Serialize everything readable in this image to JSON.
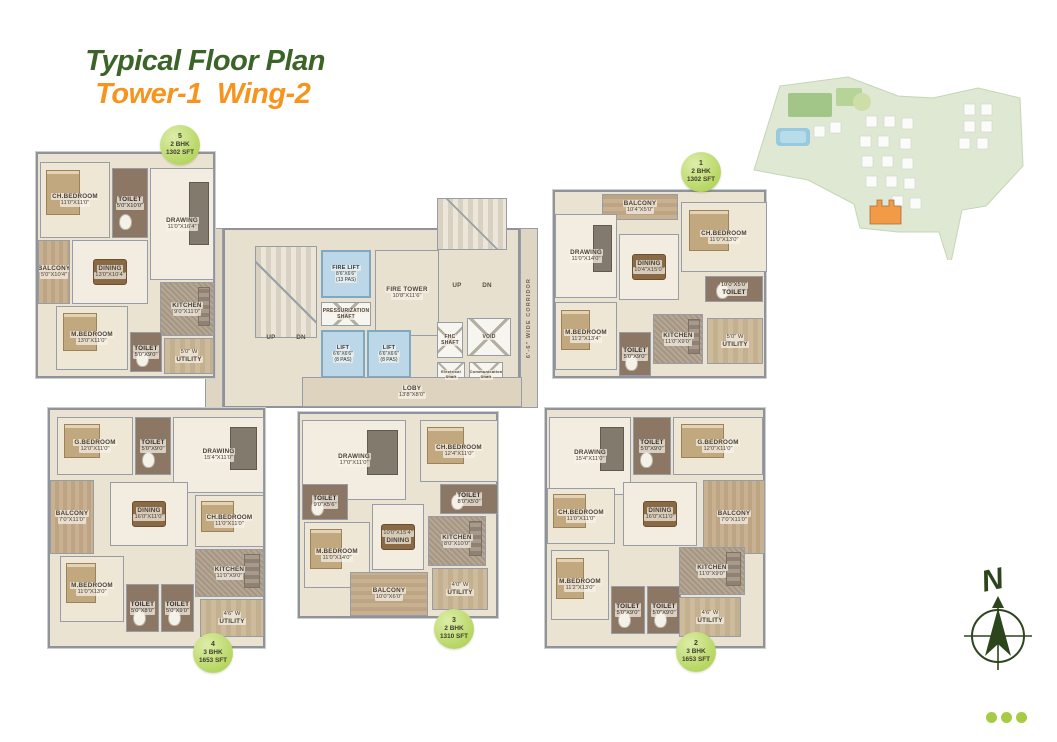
{
  "title": {
    "main": "Typical Floor Plan",
    "accent": "Tower-1  Wing-2"
  },
  "colors": {
    "title_green": "#3c6428",
    "title_orange": "#f7941e",
    "badge_green": "#b4d55e",
    "highlight_orange": "#f08119",
    "compass_green": "#2c451c"
  },
  "core": {
    "corridor_label": "6'-6\" WIDE CORRIDOR",
    "rooms": [
      {
        "label": "",
        "x": 212,
        "y": -32,
        "w": 70,
        "h": 52,
        "type": "stairs"
      },
      {
        "label": "",
        "x": 30,
        "y": 16,
        "w": 62,
        "h": 92,
        "type": "stairs"
      },
      {
        "label": "FIRE TOWER",
        "dims": "10'8\"X11'6\"",
        "x": 150,
        "y": 20,
        "w": 64,
        "h": 86,
        "type": "open"
      },
      {
        "label": "FIRE LIFT",
        "dims": "8'6\"X6'6\"",
        "extra": "(13 PAS)",
        "x": 96,
        "y": 20,
        "w": 50,
        "h": 48,
        "type": "lift"
      },
      {
        "label": "PRESSURIZATION",
        "label2": "SHAFT",
        "x": 96,
        "y": 72,
        "w": 50,
        "h": 24,
        "type": "xshaft"
      },
      {
        "label": "LIFT",
        "dims": "6'6\"X6'6\"",
        "extra": "(8 PAS)",
        "x": 96,
        "y": 100,
        "w": 44,
        "h": 48,
        "type": "lift"
      },
      {
        "label": "LIFT",
        "dims": "6'6\"X6'6\"",
        "extra": "(8 PAS)",
        "x": 142,
        "y": 100,
        "w": 44,
        "h": 48,
        "type": "lift"
      },
      {
        "label": "FHC",
        "label2": "SHAFT",
        "x": 212,
        "y": 92,
        "w": 26,
        "h": 36,
        "type": "xshaft"
      },
      {
        "label": "VOID",
        "x": 242,
        "y": 88,
        "w": 44,
        "h": 38,
        "type": "xshaft"
      },
      {
        "label": "Electrical",
        "label2": "Shaft",
        "x": 212,
        "y": 132,
        "w": 28,
        "h": 26,
        "type": "xshaft",
        "small": true
      },
      {
        "label": "Communication",
        "label2": "Shaft",
        "x": 244,
        "y": 132,
        "w": 34,
        "h": 26,
        "type": "xshaft",
        "small": true
      },
      {
        "label": "UP",
        "x": 36,
        "y": 102,
        "w": 20,
        "h": 12,
        "type": "plain"
      },
      {
        "label": "DN",
        "x": 66,
        "y": 102,
        "w": 20,
        "h": 12,
        "type": "plain"
      },
      {
        "label": "UP",
        "x": 222,
        "y": 50,
        "w": 20,
        "h": 12,
        "type": "plain"
      },
      {
        "label": "DN",
        "x": 252,
        "y": 50,
        "w": 20,
        "h": 12,
        "type": "plain"
      },
      {
        "label": "LOBY",
        "dims": "13'8\"X8'0\"",
        "x": 77,
        "y": 147,
        "w": 220,
        "h": 30,
        "type": "lobby"
      }
    ]
  },
  "units": {
    "unit5": {
      "badge": {
        "number": "5",
        "type": "2 BHK",
        "area": "1302 SFT"
      },
      "rooms": [
        {
          "label": "CH.BEDROOM",
          "dims": "11'0\"X11'0\"",
          "x": 2,
          "y": 8,
          "w": 70,
          "h": 76,
          "type": "bedroom"
        },
        {
          "label": "TOILET",
          "dims": "5'0\"X10'0\"",
          "x": 74,
          "y": 14,
          "w": 36,
          "h": 70,
          "type": "toilet"
        },
        {
          "label": "DRAWING",
          "dims": "11'0\"X16'4\"",
          "x": 112,
          "y": 14,
          "w": 64,
          "h": 112,
          "type": "drawing"
        },
        {
          "label": "BALCONY",
          "dims": "5'0\"X10'4\"",
          "x": 0,
          "y": 86,
          "w": 32,
          "h": 64,
          "type": "balcony"
        },
        {
          "label": "DINING",
          "dims": "13'0\"X10'4\"",
          "x": 34,
          "y": 86,
          "w": 76,
          "h": 64,
          "type": "dining"
        },
        {
          "label": "KITCHEN",
          "dims": "9'0\"X11'0\"",
          "x": 122,
          "y": 128,
          "w": 54,
          "h": 54,
          "type": "kitchen"
        },
        {
          "label": "M.BEDROOM",
          "dims": "13'0\"X11'0\"",
          "x": 18,
          "y": 152,
          "w": 72,
          "h": 64,
          "type": "bedroom"
        },
        {
          "label": "TOILET",
          "dims": "5'0\"X9'0\"",
          "x": 92,
          "y": 178,
          "w": 32,
          "h": 40,
          "type": "toilet"
        },
        {
          "label": "UTILITY",
          "dims": "5'0\" W",
          "dims_first": true,
          "x": 126,
          "y": 184,
          "w": 50,
          "h": 36,
          "type": "utility"
        }
      ]
    },
    "unit1": {
      "badge": {
        "number": "1",
        "type": "2 BHK",
        "area": "1302 SFT"
      },
      "rooms": [
        {
          "label": "BALCONY",
          "dims": "10'4\"X5'0\"",
          "x": 47,
          "y": 2,
          "w": 76,
          "h": 26,
          "type": "balcony",
          "hstripe": true
        },
        {
          "label": "CH.BEDROOM",
          "dims": "11'0\"X13'0\"",
          "x": 126,
          "y": 10,
          "w": 86,
          "h": 70,
          "type": "bedroom"
        },
        {
          "label": "DRAWING",
          "dims": "11'0\"X14'0\"",
          "x": 0,
          "y": 22,
          "w": 62,
          "h": 84,
          "type": "drawing"
        },
        {
          "label": "DINING",
          "dims": "10'4\"X15'0\"",
          "x": 64,
          "y": 42,
          "w": 60,
          "h": 66,
          "type": "dining"
        },
        {
          "label": "TOILET",
          "dims": "10'0\"X5'0\"",
          "dims_first": true,
          "x": 150,
          "y": 84,
          "w": 58,
          "h": 26,
          "type": "toilet"
        },
        {
          "label": "M.BEDROOM",
          "dims": "11'2\"X13'4\"",
          "x": 0,
          "y": 110,
          "w": 62,
          "h": 68,
          "type": "bedroom"
        },
        {
          "label": "TOILET",
          "dims": "5'0\"X9'0\"",
          "x": 64,
          "y": 140,
          "w": 32,
          "h": 44,
          "type": "toilet"
        },
        {
          "label": "KITCHEN",
          "dims": "11'0\"X9'0\"",
          "x": 98,
          "y": 122,
          "w": 50,
          "h": 50,
          "type": "kitchen"
        },
        {
          "label": "UTILITY",
          "dims": "5'0\" W",
          "dims_first": true,
          "x": 152,
          "y": 126,
          "w": 56,
          "h": 46,
          "type": "utility"
        }
      ]
    },
    "unit4": {
      "badge": {
        "number": "4",
        "type": "3 BHK",
        "area": "1653 SFT"
      },
      "rooms": [
        {
          "label": "G.BEDROOM",
          "dims": "12'0\"X11'0\"",
          "x": 7,
          "y": 7,
          "w": 76,
          "h": 58,
          "type": "bedroom"
        },
        {
          "label": "TOILET",
          "dims": "5'0\"X9'0\"",
          "x": 85,
          "y": 7,
          "w": 36,
          "h": 58,
          "type": "toilet"
        },
        {
          "label": "DRAWING",
          "dims": "15'4\"X11'0\"",
          "x": 123,
          "y": 7,
          "w": 91,
          "h": 76,
          "type": "drawing"
        },
        {
          "label": "BALCONY",
          "dims": "7'0\"X11'0\"",
          "x": 0,
          "y": 70,
          "w": 44,
          "h": 74,
          "type": "balcony"
        },
        {
          "label": "DINING",
          "dims": "16'0\"X11'0\"",
          "x": 60,
          "y": 72,
          "w": 78,
          "h": 64,
          "type": "dining"
        },
        {
          "label": "CH.BEDROOM",
          "dims": "11'0\"X11'0\"",
          "x": 145,
          "y": 85,
          "w": 69,
          "h": 52,
          "type": "bedroom"
        },
        {
          "label": "M.BEDROOM",
          "dims": "11'0\"X13'0\"",
          "x": 10,
          "y": 146,
          "w": 64,
          "h": 66,
          "type": "bedroom"
        },
        {
          "label": "TOILET",
          "dims": "5'0\"X8'0\"",
          "x": 76,
          "y": 174,
          "w": 33,
          "h": 48,
          "type": "toilet"
        },
        {
          "label": "TOILET",
          "dims": "5'0\"X9'0\"",
          "x": 111,
          "y": 174,
          "w": 33,
          "h": 48,
          "type": "toilet"
        },
        {
          "label": "KITCHEN",
          "dims": "11'0\"X9'0\"",
          "x": 145,
          "y": 139,
          "w": 69,
          "h": 48,
          "type": "kitchen"
        },
        {
          "label": "UTILITY",
          "dims": "4'6\" W",
          "dims_first": true,
          "x": 150,
          "y": 189,
          "w": 64,
          "h": 38,
          "type": "utility"
        }
      ]
    },
    "unit3": {
      "badge": {
        "number": "3",
        "type": "2 BHK",
        "area": "1310 SFT"
      },
      "rooms": [
        {
          "label": "DRAWING",
          "dims": "17'0\"X11'0\"",
          "x": 2,
          "y": 6,
          "w": 104,
          "h": 80,
          "type": "drawing"
        },
        {
          "label": "CH.BEDROOM",
          "dims": "12'4\"X11'0\"",
          "x": 120,
          "y": 6,
          "w": 78,
          "h": 62,
          "type": "bedroom"
        },
        {
          "label": "TOILET",
          "dims": "9'0\"X5'6\"",
          "x": 2,
          "y": 70,
          "w": 46,
          "h": 36,
          "type": "toilet"
        },
        {
          "label": "TOILET",
          "dims": "8'0\"X5'0\"",
          "x": 140,
          "y": 70,
          "w": 58,
          "h": 30,
          "type": "toilet"
        },
        {
          "label": "M.BEDROOM",
          "dims": "11'0\"X14'0\"",
          "x": 4,
          "y": 108,
          "w": 66,
          "h": 66,
          "type": "bedroom"
        },
        {
          "label": "DINING",
          "dims": "10'0\"X15'4\"",
          "dims_first": true,
          "x": 72,
          "y": 90,
          "w": 52,
          "h": 66,
          "type": "dining"
        },
        {
          "label": "KITCHEN",
          "dims": "8'0\"X10'0\"",
          "x": 128,
          "y": 102,
          "w": 58,
          "h": 50,
          "type": "kitchen"
        },
        {
          "label": "BALCONY",
          "dims": "10'0\"X6'0\"",
          "x": 50,
          "y": 158,
          "w": 78,
          "h": 44,
          "type": "balcony",
          "hstripe": true
        },
        {
          "label": "UTILITY",
          "dims": "4'0\" W",
          "dims_first": true,
          "x": 132,
          "y": 154,
          "w": 56,
          "h": 42,
          "type": "utility"
        }
      ]
    },
    "unit2": {
      "badge": {
        "number": "2",
        "type": "3 BHK",
        "area": "1653 SFT"
      },
      "rooms": [
        {
          "label": "DRAWING",
          "dims": "15'4\"X11'0\"",
          "x": 2,
          "y": 7,
          "w": 82,
          "h": 78,
          "type": "drawing"
        },
        {
          "label": "TOILET",
          "dims": "5'0\"X9'0\"",
          "x": 86,
          "y": 7,
          "w": 38,
          "h": 58,
          "type": "toilet"
        },
        {
          "label": "G.BEDROOM",
          "dims": "12'0\"X11'0\"",
          "x": 126,
          "y": 7,
          "w": 90,
          "h": 58,
          "type": "bedroom"
        },
        {
          "label": "CH.BEDROOM",
          "dims": "11'0\"X11'0\"",
          "x": 0,
          "y": 78,
          "w": 68,
          "h": 56,
          "type": "bedroom"
        },
        {
          "label": "DINING",
          "dims": "16'0\"X11'0\"",
          "x": 76,
          "y": 72,
          "w": 74,
          "h": 64,
          "type": "dining"
        },
        {
          "label": "BALCONY",
          "dims": "7'0\"X11'0\"",
          "x": 156,
          "y": 70,
          "w": 62,
          "h": 74,
          "type": "balcony"
        },
        {
          "label": "M.BEDROOM",
          "dims": "11'2\"X13'0\"",
          "x": 4,
          "y": 140,
          "w": 58,
          "h": 70,
          "type": "bedroom"
        },
        {
          "label": "TOILET",
          "dims": "5'0\"X9'0\"",
          "x": 64,
          "y": 176,
          "w": 34,
          "h": 48,
          "type": "toilet"
        },
        {
          "label": "TOILET",
          "dims": "5'0\"X9'0\"",
          "x": 100,
          "y": 176,
          "w": 34,
          "h": 48,
          "type": "toilet"
        },
        {
          "label": "KITCHEN",
          "dims": "11'0\"X9'0\"",
          "x": 132,
          "y": 137,
          "w": 66,
          "h": 48,
          "type": "kitchen"
        },
        {
          "label": "UTILITY",
          "dims": "4'6\" W",
          "dims_first": true,
          "x": 132,
          "y": 187,
          "w": 62,
          "h": 40,
          "type": "utility"
        }
      ]
    }
  },
  "compass": {
    "north_label": "N"
  }
}
